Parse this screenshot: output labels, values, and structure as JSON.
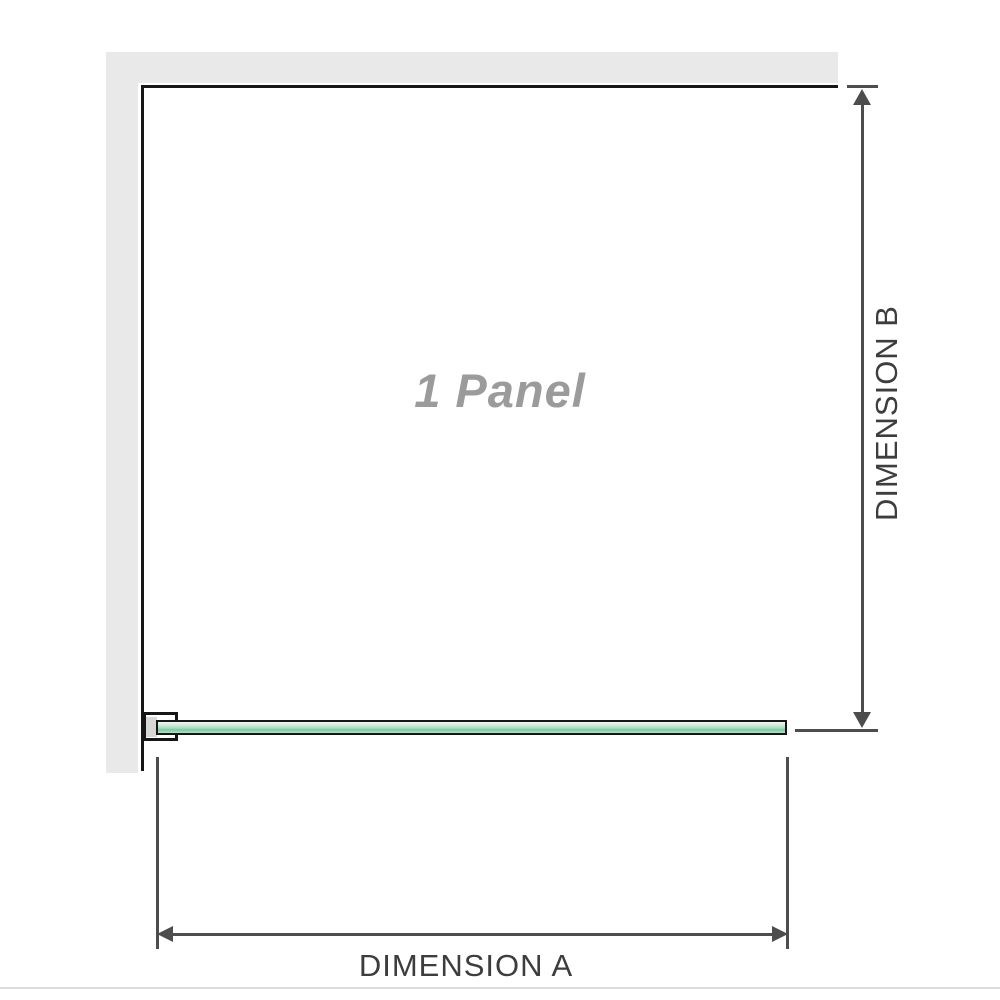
{
  "diagram": {
    "panel_label": "1 Panel",
    "dimension_a_label": "DIMENSION A",
    "dimension_b_label": "DIMENSION B"
  },
  "colors": {
    "wall": "#e9e9e9",
    "outline": "#161616",
    "glass_light": "#eef8f1",
    "glass_mid": "#a8dcbd",
    "glass_dark": "#7fc9a0",
    "arrow": "#4d4d4d",
    "label_gray": "#9b9b9b",
    "dim_text": "#3d3d3d",
    "baseline": "#dcdcdc"
  }
}
